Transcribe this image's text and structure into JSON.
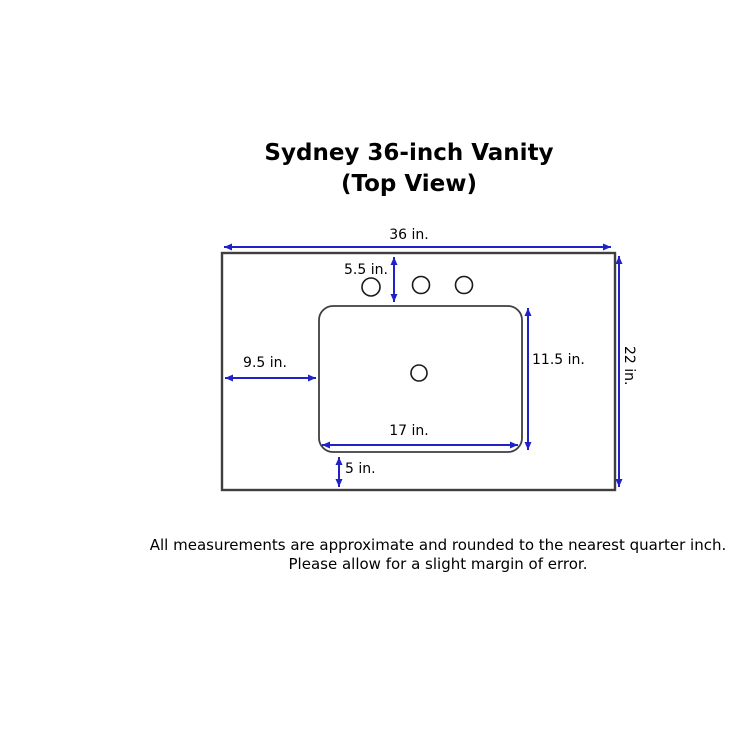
{
  "title": {
    "line1": "Sydney 36-inch Vanity",
    "line2": "(Top View)"
  },
  "dimensions": {
    "overall_width": "36 in.",
    "overall_depth": "22 in.",
    "faucet_offset": "5.5 in.",
    "left_offset": "9.5 in.",
    "sink_depth": "11.5 in.",
    "sink_width": "17 in.",
    "bottom_offset": "5 in."
  },
  "footer": {
    "line1": "All measurements are approximate and rounded to the nearest quarter inch.",
    "line2": "Please allow for a slight margin of error."
  },
  "colors": {
    "arrow": "#2121c8",
    "outline": "#3f3f3f",
    "text": "#000000",
    "background": "#ffffff"
  }
}
